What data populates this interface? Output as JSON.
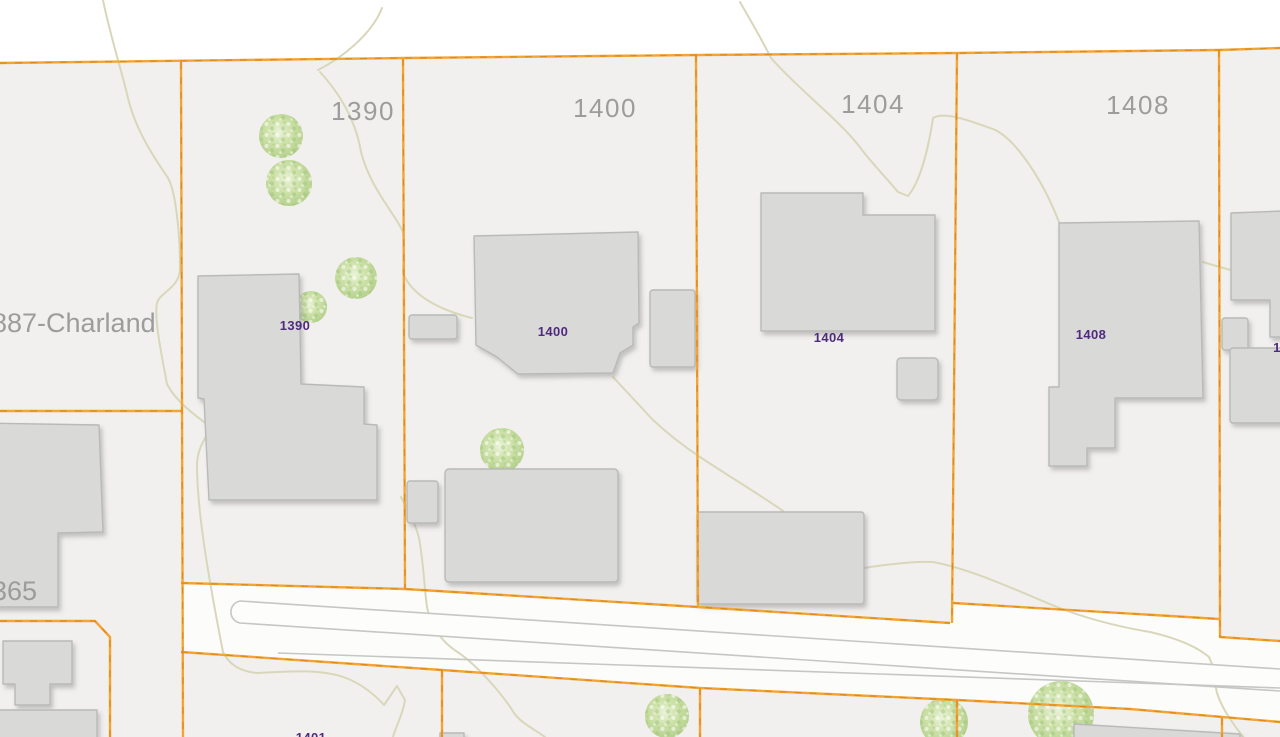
{
  "map": {
    "type": "cadastral-parcel-map",
    "lot_number_labels": [
      {
        "text": "1390"
      },
      {
        "text": "1400"
      },
      {
        "text": "1404"
      },
      {
        "text": "1408"
      }
    ],
    "street_address_labels": [
      {
        "text": "887-Charland"
      },
      {
        "text": "365"
      }
    ],
    "building_number_labels": [
      {
        "text": "1390"
      },
      {
        "text": "1400"
      },
      {
        "text": "1404"
      },
      {
        "text": "1408"
      },
      {
        "text": "1401"
      },
      {
        "text": "1"
      }
    ],
    "colors": {
      "parcel_background": "#f1f0ee",
      "top_margin_white": "#ffffff",
      "road_corridor_white": "#fcfcfb",
      "parcel_boundary_orange": "#f2a434",
      "parcel_boundary_dash_orange": "#dd8a1a",
      "building_fill": "#d9d9d7",
      "building_outline": "#b9b9b7",
      "road_edge_gray": "#c6c6c4",
      "contour_line_olive": "#d9d7ba",
      "tree_green": "#c8dca2",
      "lot_label_gray": "#9c9c9c",
      "building_label_purple": "#4f2a7f"
    }
  }
}
